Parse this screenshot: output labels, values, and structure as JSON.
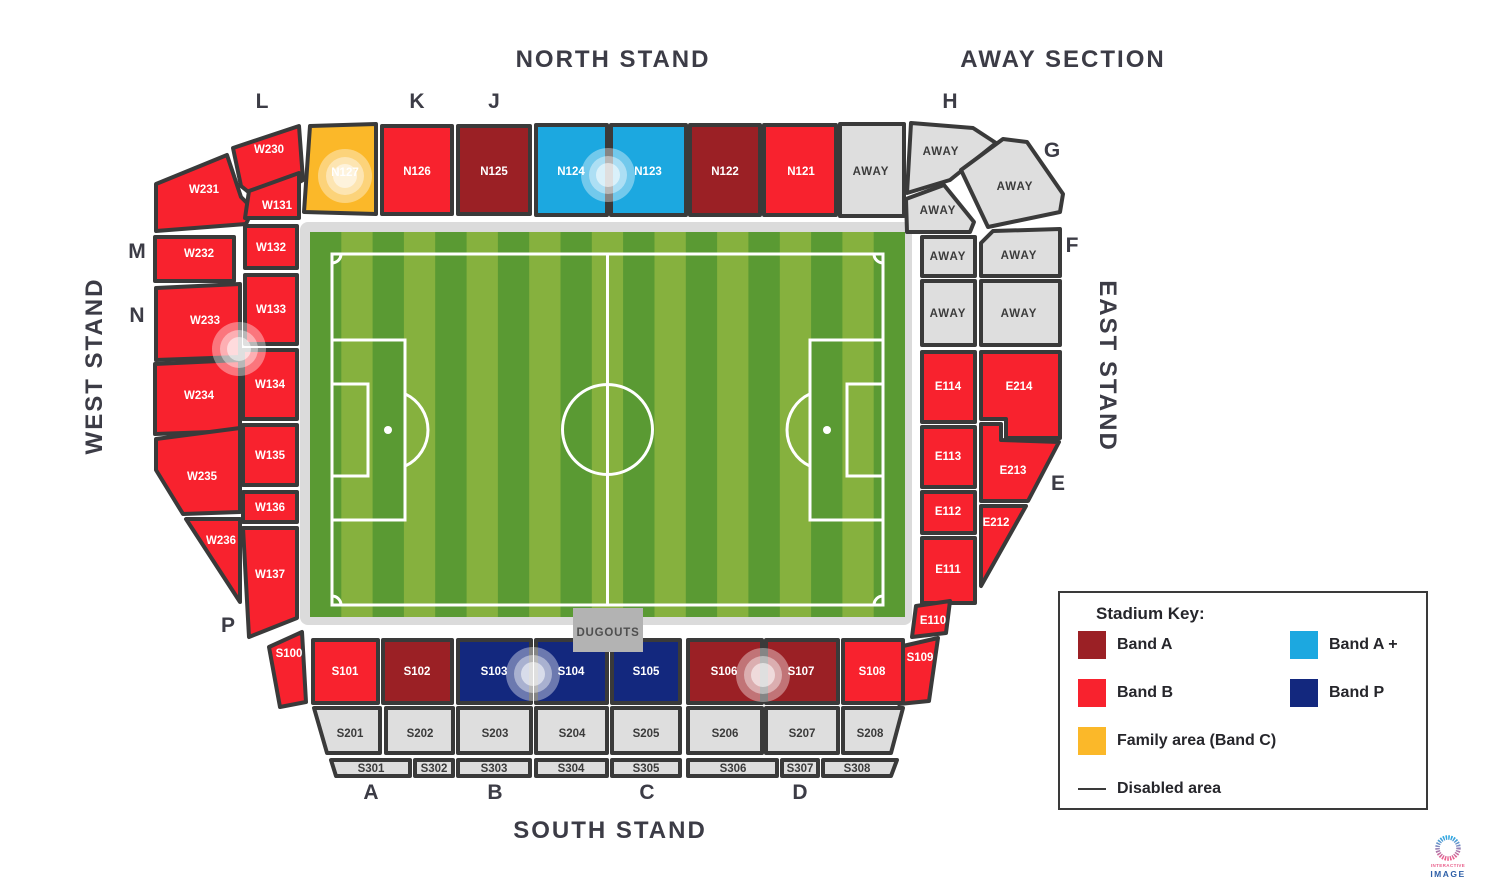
{
  "titles": {
    "north": "NORTH STAND",
    "away": "AWAY SECTION",
    "south": "SOUTH STAND",
    "west": "WEST STAND",
    "east": "EAST STAND"
  },
  "stand_letters": {
    "l": "L",
    "k": "K",
    "j": "J",
    "h": "H",
    "g": "G",
    "f": "F",
    "e": "E",
    "m": "M",
    "n": "N",
    "p": "P",
    "a": "A",
    "b": "B",
    "c": "C",
    "d": "D"
  },
  "key_colors": {
    "band_a": "#9B2025",
    "band_a_plus": "#1CA8E0",
    "band_b": "#F8222E",
    "band_p": "#13287E",
    "band_c": "#FBB829",
    "away": "#DEDEDE",
    "outline": "#3A3A3A",
    "pitch_dark": "#5A9A33",
    "pitch_light": "#86B13E",
    "frame": "#DBDBDB",
    "dugout": "#B3B3B3"
  },
  "pitch": {
    "dugouts_label": "DUGOUTS"
  },
  "legend": {
    "title": "Stadium Key:",
    "items": [
      {
        "label": "Band A"
      },
      {
        "label": "Band A +"
      },
      {
        "label": "Band B"
      },
      {
        "label": "Band P"
      },
      {
        "label": "Family area (Band C)"
      }
    ],
    "disabled_label": "Disabled area"
  },
  "sections": {
    "w230": {
      "label": "W230"
    },
    "w231": {
      "label": "W231"
    },
    "w232": {
      "label": "W232"
    },
    "w233": {
      "label": "W233"
    },
    "w234": {
      "label": "W234"
    },
    "w235": {
      "label": "W235"
    },
    "w236": {
      "label": "W236"
    },
    "w131": {
      "label": "W131"
    },
    "w132": {
      "label": "W132"
    },
    "w133": {
      "label": "W133"
    },
    "w134": {
      "label": "W134"
    },
    "w135": {
      "label": "W135"
    },
    "w136": {
      "label": "W136"
    },
    "w137": {
      "label": "W137"
    },
    "n127": {
      "label": "N127"
    },
    "n126": {
      "label": "N126"
    },
    "n125": {
      "label": "N125"
    },
    "n124": {
      "label": "N124"
    },
    "n123": {
      "label": "N123"
    },
    "n122": {
      "label": "N122"
    },
    "n121": {
      "label": "N121"
    },
    "away1": {
      "label": "AWAY"
    },
    "away2": {
      "label": "AWAY"
    },
    "away3": {
      "label": "AWAY"
    },
    "away4": {
      "label": "AWAY"
    },
    "away5": {
      "label": "AWAY"
    },
    "away6": {
      "label": "AWAY"
    },
    "away7": {
      "label": "AWAY"
    },
    "away8": {
      "label": "AWAY"
    },
    "e114": {
      "label": "E114"
    },
    "e214": {
      "label": "E214"
    },
    "e113": {
      "label": "E113"
    },
    "e213": {
      "label": "E213"
    },
    "e112": {
      "label": "E112"
    },
    "e212": {
      "label": "E212"
    },
    "e111": {
      "label": "E111"
    },
    "e110": {
      "label": "E110"
    },
    "s100": {
      "label": "S100"
    },
    "s101": {
      "label": "S101"
    },
    "s102": {
      "label": "S102"
    },
    "s103": {
      "label": "S103"
    },
    "s104": {
      "label": "S104"
    },
    "s105": {
      "label": "S105"
    },
    "s106": {
      "label": "S106"
    },
    "s107": {
      "label": "S107"
    },
    "s108": {
      "label": "S108"
    },
    "s109": {
      "label": "S109"
    },
    "s201": {
      "label": "S201"
    },
    "s202": {
      "label": "S202"
    },
    "s203": {
      "label": "S203"
    },
    "s204": {
      "label": "S204"
    },
    "s205": {
      "label": "S205"
    },
    "s206": {
      "label": "S206"
    },
    "s207": {
      "label": "S207"
    },
    "s208": {
      "label": "S208"
    },
    "s301": {
      "label": "S301"
    },
    "s302": {
      "label": "S302"
    },
    "s303": {
      "label": "S303"
    },
    "s304": {
      "label": "S304"
    },
    "s305": {
      "label": "S305"
    },
    "s306": {
      "label": "S306"
    },
    "s307": {
      "label": "S307"
    },
    "s308": {
      "label": "S308"
    }
  },
  "logo": {
    "line1": "INTERACTIVE",
    "line2": "IMAGE"
  }
}
